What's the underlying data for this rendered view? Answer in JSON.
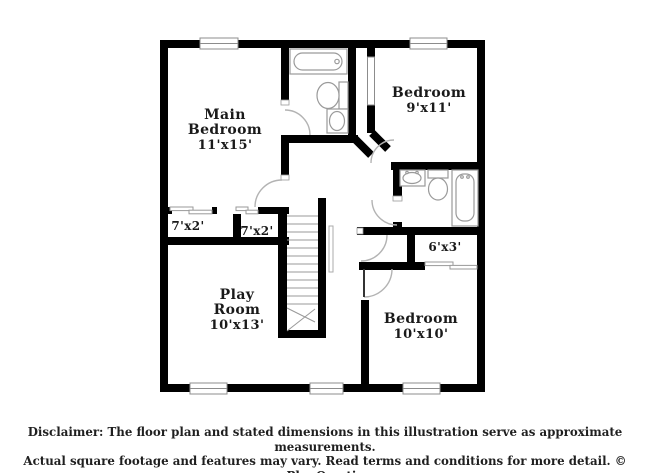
{
  "floorplan": {
    "labels": {
      "main_bedroom": {
        "name_line1": "Main",
        "name_line2": "Bedroom",
        "dims": "11'x15'"
      },
      "bedroom_top_right": {
        "name_line1": "Bedroom",
        "dims": "9'x11'"
      },
      "closet_left": {
        "dims": "7'x2'"
      },
      "closet_mid": {
        "dims": "7'x2'"
      },
      "closet_hall": {
        "dims": "6'x3'"
      },
      "play_room": {
        "name_line1": "Play",
        "name_line2": "Room",
        "dims": "10'x13'"
      },
      "bedroom_bottom_right": {
        "name_line1": "Bedroom",
        "dims": "10'x10'"
      }
    },
    "colors": {
      "wall": "#000000",
      "fixture_outline": "#9a9a9a",
      "door_arc": "#b3b3b3"
    }
  },
  "disclaimer": {
    "line1": "Disclaimer: The floor plan and stated dimensions in this illustration serve as approximate measurements.",
    "line2": "Actual square footage and features may vary. Read terms and conditions for more detail. © PlanOmatic"
  }
}
